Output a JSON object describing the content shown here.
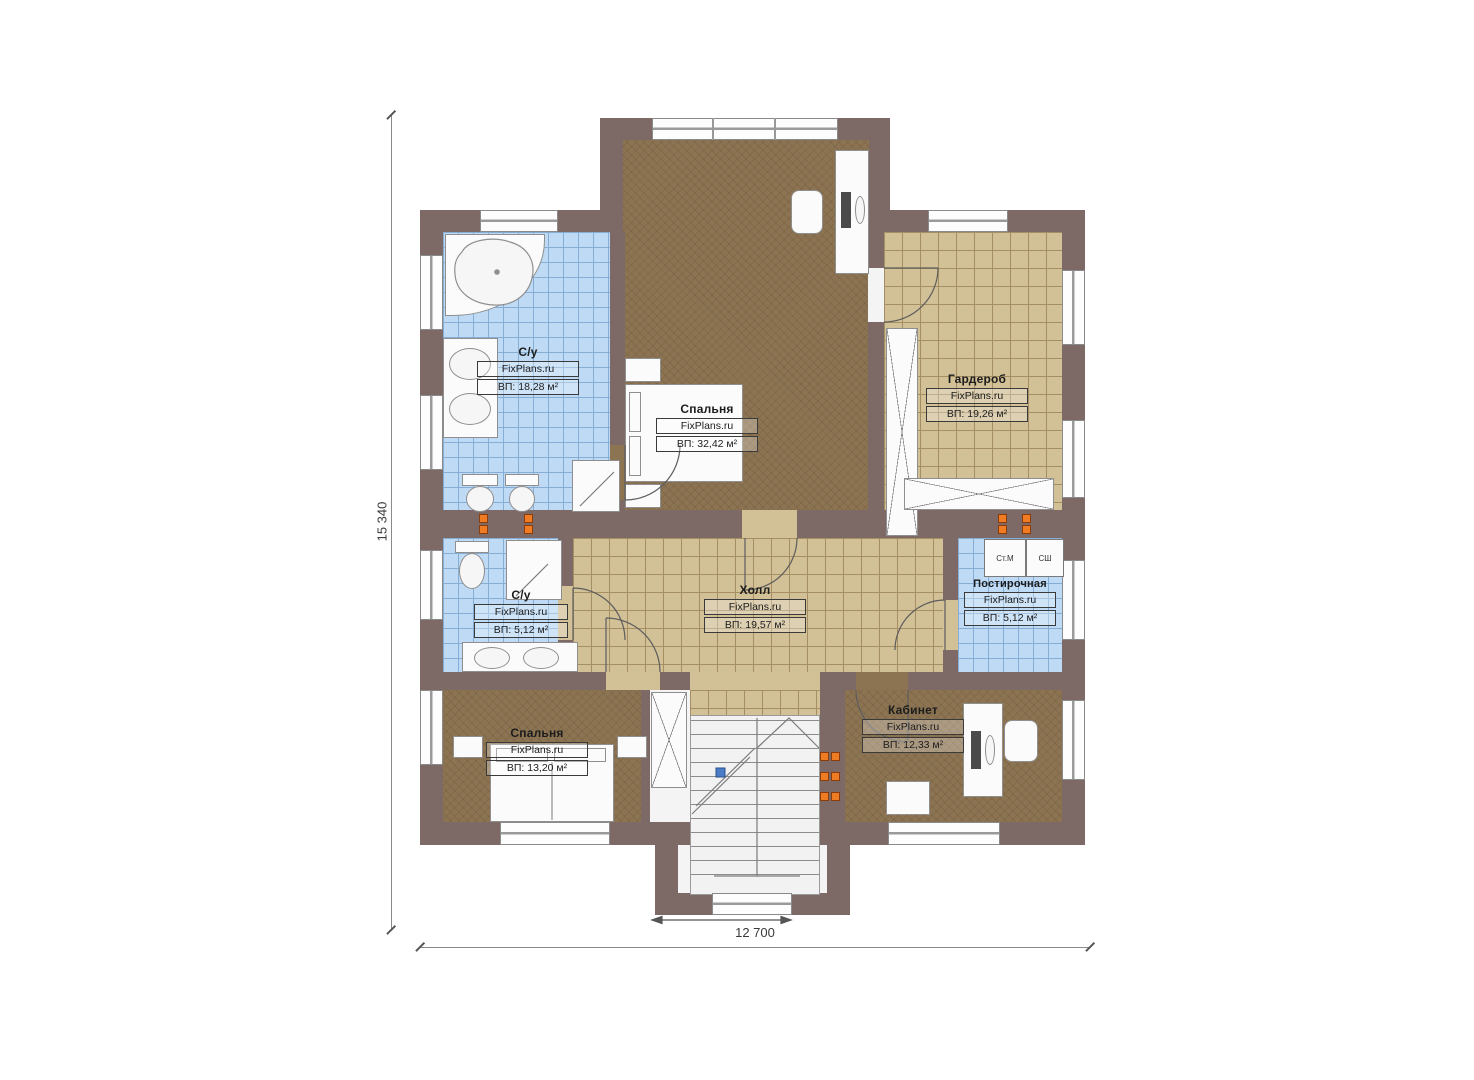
{
  "plan": {
    "type": "second-floor-plan",
    "brand": "FixPlans.ru"
  },
  "dimensions": {
    "height_label": "15 340",
    "width_label": "12 700"
  },
  "rooms": [
    {
      "name": "С/у",
      "brand": "FixPlans.ru",
      "area": "ВП: 18,28 м²"
    },
    {
      "name": "Спальня",
      "brand": "FixPlans.ru",
      "area": "ВП: 32,42 м²"
    },
    {
      "name": "Гардероб",
      "brand": "FixPlans.ru",
      "area": "ВП: 19,26 м²"
    },
    {
      "name": "Холл",
      "brand": "FixPlans.ru",
      "area": "ВП: 19,57 м²"
    },
    {
      "name": "С/у",
      "brand": "FixPlans.ru",
      "area": "ВП: 5,12 м²"
    },
    {
      "name": "Постирочная",
      "brand": "FixPlans.ru",
      "area": "ВП: 5,12 м²"
    },
    {
      "name": "Спальня",
      "brand": "FixPlans.ru",
      "area": "ВП: 13,20 м²"
    },
    {
      "name": "Кабинет",
      "brand": "FixPlans.ru",
      "area": "ВП: 12,33 м²"
    }
  ],
  "appliances": {
    "washer": "Ст.М",
    "dryer": "СШ"
  },
  "colors": {
    "wall": "#7d6a67",
    "tile_blue": "#bedaf4",
    "tile_blue_line": "#86add4",
    "floor_tan": "#d2c096",
    "floor_tan_line": "#a68e63",
    "floor_wood": "#8c7453",
    "fixture_white": "#fbfbfb",
    "outlet_orange": "#ef7b22",
    "stair_white": "#f2f2f2"
  }
}
